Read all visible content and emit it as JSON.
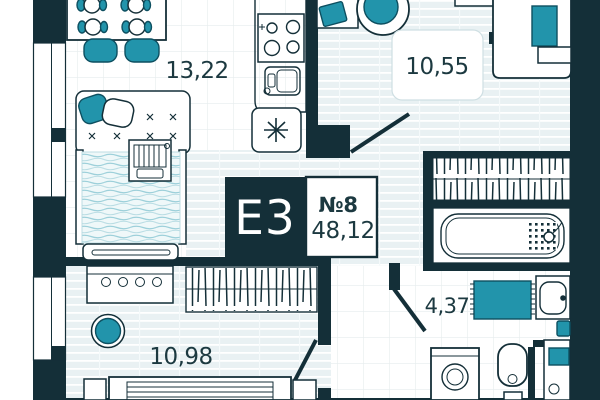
{
  "plan": {
    "code": "E3",
    "unit_number": "№8",
    "total_area": "48,12",
    "rooms": {
      "living_kitchen": {
        "area": "13,22"
      },
      "bedroom": {
        "area": "10,55"
      },
      "bedroom2": {
        "area": "10,98"
      },
      "bathroom": {
        "area": "4,37"
      }
    },
    "colors": {
      "wall": "#142f38",
      "accent_teal": "#2294ab",
      "floor_stripe": "#e9f1f3",
      "text": "#1c3940"
    }
  }
}
